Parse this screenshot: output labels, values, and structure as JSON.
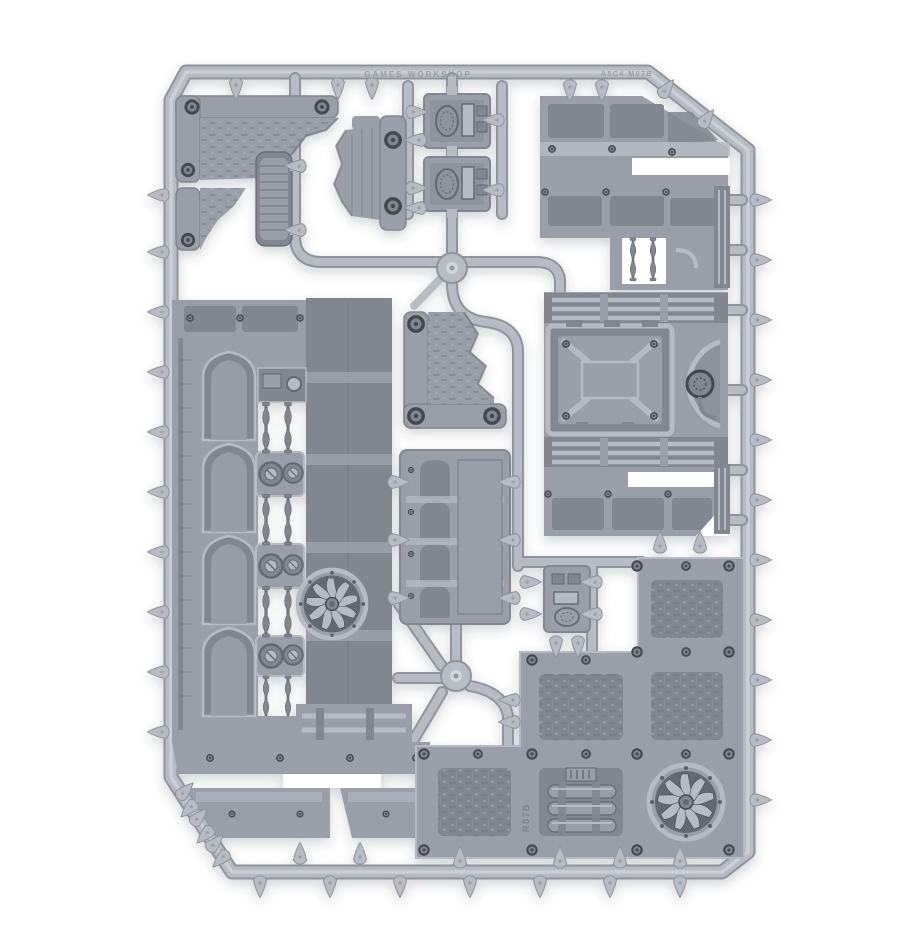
{
  "subject": "grey plastic model kit sprue (industrial terrain frame) photographed on white",
  "palette": {
    "bg": "#ffffff",
    "runner": "#b7bbc3",
    "runner_hi": "#d0d3d8",
    "runner_lo": "#8f949d",
    "part": "#999ea8",
    "part_hi": "#b6bac2",
    "part_lo": "#81868f",
    "deep": "#646973",
    "ink": "#45494f",
    "blade": "#747983"
  },
  "embossed_marks": {
    "brand": "GAMES WORKSHOP",
    "code_right": "A5C4 M07B",
    "part_code": "R07B"
  },
  "parts": [
    {
      "name": "sprue-frame",
      "count": 1
    },
    {
      "name": "ruined-floor-corner",
      "count": 2
    },
    {
      "name": "ribbed-column",
      "count": 1
    },
    {
      "name": "ruined-wall-segment",
      "count": 1
    },
    {
      "name": "small-hatch-panel",
      "count": 3
    },
    {
      "name": "large-industrial-wall",
      "count": 1
    },
    {
      "name": "upper-right-wall-section",
      "count": 1
    },
    {
      "name": "blast-door-wall",
      "count": 1
    },
    {
      "name": "arched-wall-panel",
      "count": 1
    },
    {
      "name": "turbine-fan",
      "count": 2
    },
    {
      "name": "floor-tile-assembly",
      "count": 1
    },
    {
      "name": "pipe-machinery-cell",
      "count": 1
    },
    {
      "name": "piston-spindle",
      "count": 10
    },
    {
      "name": "wheel-pulley",
      "count": 6
    }
  ]
}
